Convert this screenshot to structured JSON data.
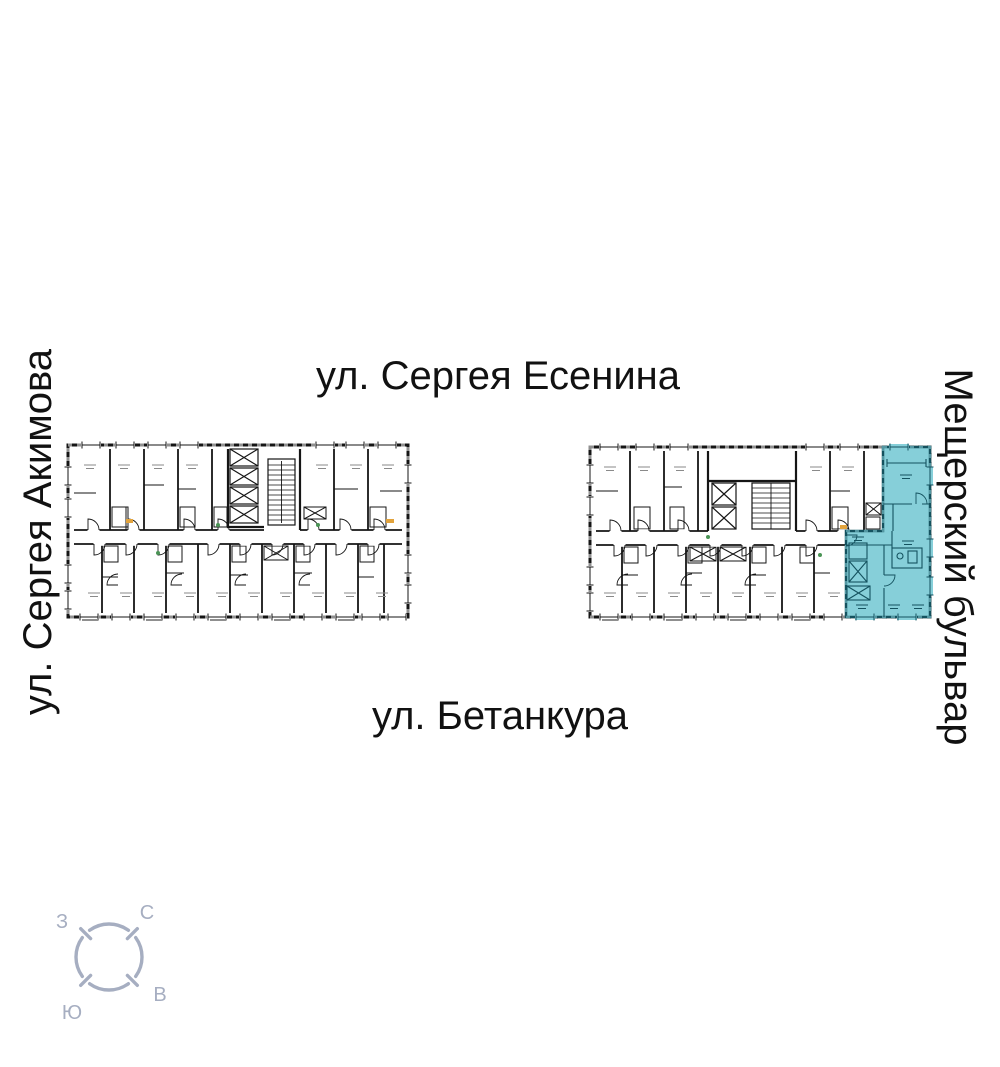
{
  "page": {
    "background_color": "#ffffff"
  },
  "streets": {
    "top": "ул. Сергея Есенина",
    "bottom": "ул. Бетанкура",
    "left": "ул. Сергея Акимова",
    "right": "Мещерский бульвар"
  },
  "compass": {
    "color": "#A6AEC1",
    "north_label": "С",
    "south_label": "Ю",
    "west_label": "З",
    "east_label": "В"
  },
  "floorplan": {
    "line_color": "#151515",
    "hatch_color": "#8f8f8f",
    "label_color": "#8a8a8a",
    "fixture_orange": "#E2A33C",
    "fixture_green": "#4A9455",
    "buildings": [
      "left-section",
      "right-section"
    ],
    "highlight": {
      "building": "right-section",
      "fill": "#86CFD9",
      "line": "#14525F"
    }
  }
}
